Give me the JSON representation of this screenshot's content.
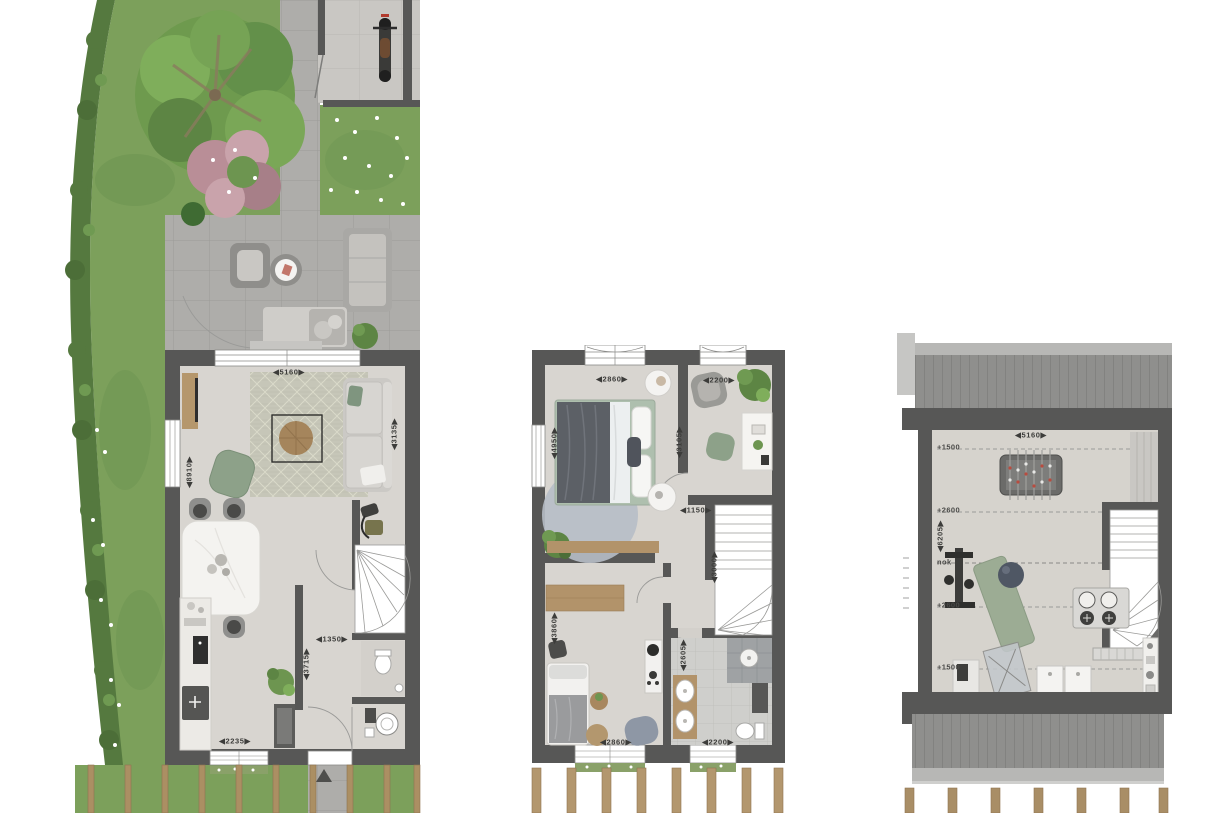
{
  "document": {
    "type": "architectural-floor-plans",
    "sheet_background": "#ffffff"
  },
  "colors": {
    "wall": "#575756",
    "floor": "#d8d5d0",
    "grass": "#7ca05b",
    "hedge": "#55793f",
    "paving": "#aeadaa",
    "roof": "#8f8f8d",
    "wood": "#b3976e",
    "dimension_text": "#3c3c3a",
    "accent_green": "#8da189"
  },
  "plans": [
    {
      "name": "ground-floor",
      "dimensions": [
        {
          "text": "5160",
          "x": 289,
          "y": 372,
          "orient": "h"
        },
        {
          "text": "3135",
          "x": 394,
          "y": 434,
          "orient": "v"
        },
        {
          "text": "8910",
          "x": 189,
          "y": 472,
          "orient": "v"
        },
        {
          "text": "1350",
          "x": 332,
          "y": 639,
          "orient": "h"
        },
        {
          "text": "3715",
          "x": 306,
          "y": 664,
          "orient": "v"
        },
        {
          "text": "2235",
          "x": 235,
          "y": 741,
          "orient": "h"
        }
      ]
    },
    {
      "name": "first-floor",
      "dimensions": [
        {
          "text": "2860",
          "x": 612,
          "y": 379,
          "orient": "h"
        },
        {
          "text": "2200",
          "x": 719,
          "y": 380,
          "orient": "h"
        },
        {
          "text": "4950",
          "x": 554,
          "y": 443,
          "orient": "v"
        },
        {
          "text": "3105",
          "x": 679,
          "y": 442,
          "orient": "v"
        },
        {
          "text": "1150",
          "x": 696,
          "y": 510,
          "orient": "h"
        },
        {
          "text": "3000",
          "x": 714,
          "y": 567,
          "orient": "v"
        },
        {
          "text": "3860",
          "x": 554,
          "y": 628,
          "orient": "v"
        },
        {
          "text": "2605",
          "x": 683,
          "y": 655,
          "orient": "v"
        },
        {
          "text": "2860",
          "x": 616,
          "y": 742,
          "orient": "h"
        },
        {
          "text": "2200",
          "x": 718,
          "y": 742,
          "orient": "h"
        }
      ]
    },
    {
      "name": "second-floor-attic",
      "dimensions": [
        {
          "text": "5160",
          "x": 1031,
          "y": 435,
          "orient": "h"
        },
        {
          "text": "6205",
          "x": 940,
          "y": 536,
          "orient": "v"
        }
      ],
      "height_lines": [
        {
          "text": "+1500",
          "x": 937,
          "y": 447
        },
        {
          "text": "+2600",
          "x": 937,
          "y": 510
        },
        {
          "text": "nok",
          "x": 937,
          "y": 562
        },
        {
          "text": "+2600",
          "x": 937,
          "y": 605
        },
        {
          "text": "+1500",
          "x": 937,
          "y": 667
        }
      ]
    }
  ]
}
